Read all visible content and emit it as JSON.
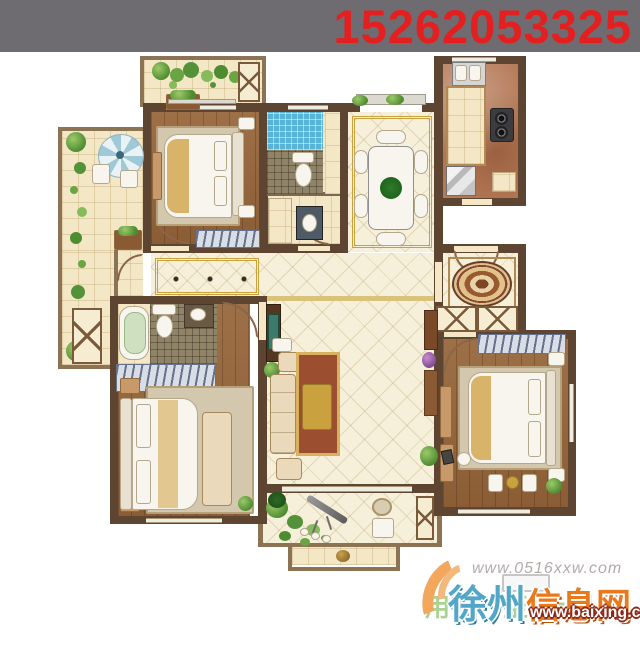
{
  "banner": {
    "phone": "15262053325"
  },
  "watermarks": {
    "site_url": "www.0516xxw.com",
    "brand_city": "徐州",
    "brand_suffix": "信息网",
    "baixing_url": "www.baixing.com",
    "slogan": "用户至上"
  },
  "colors": {
    "banner_bg": "#6e6c71",
    "phone_red": "#e41f1f",
    "wall_brown": "#5e4531",
    "brand_blue": "#52a6c8",
    "brand_orange": "#e87a1e",
    "swoosh_orange": "#f2a75c"
  }
}
